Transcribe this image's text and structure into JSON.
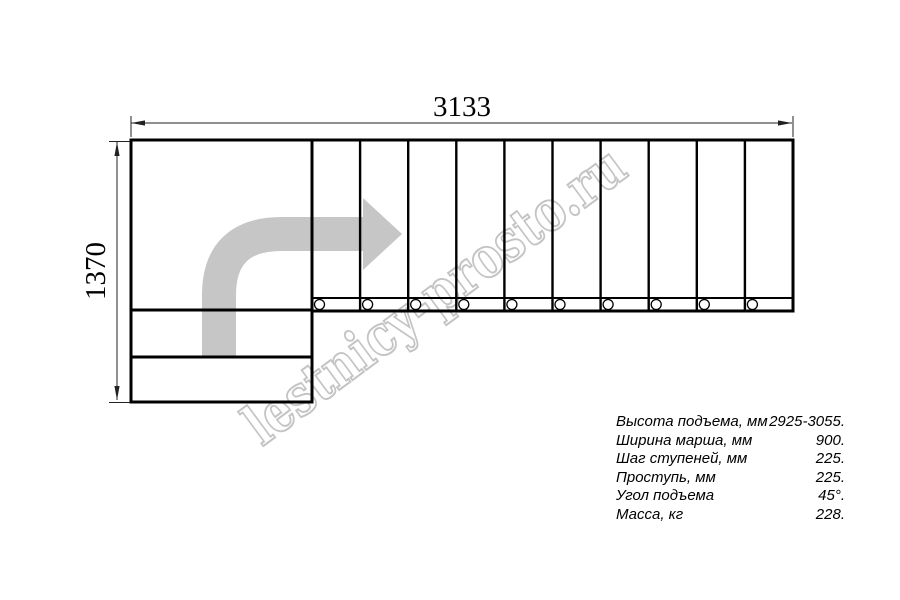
{
  "watermark": {
    "text": "lestnicy-prosto.ru",
    "color": "#c4c4c4"
  },
  "dimensions": {
    "width_label": "3133",
    "height_label": "1370"
  },
  "drawing": {
    "tread_count": 10,
    "screw_hole_count": 10,
    "colors": {
      "outline": "#000000",
      "dimension_line": "#222222",
      "direction_arrow": "#c6c6c6",
      "background": "#ffffff"
    }
  },
  "specs": {
    "rows": [
      {
        "label": "Высота подъема, мм",
        "value": "2925-3055."
      },
      {
        "label": "Ширина марша, мм",
        "value": "900."
      },
      {
        "label": "Шаг ступеней, мм",
        "value": "225."
      },
      {
        "label": "Проступь, мм",
        "value": "225."
      },
      {
        "label": "Угол подъема",
        "value": "45°."
      },
      {
        "label": "Масса, кг",
        "value": "228."
      }
    ]
  }
}
